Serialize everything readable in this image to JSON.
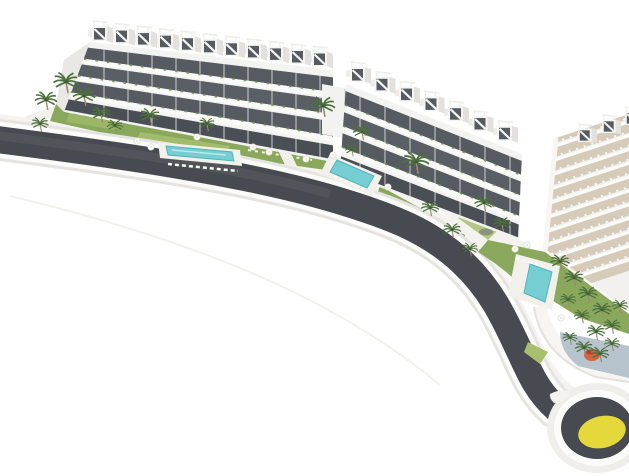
{
  "scene": {
    "type": "architectural-aerial-render",
    "subject": "curved white apartment complex with rooftop pergola penthouses, landscaped gardens, three swimming pools, palm trees, a dark perimeter road with white curbs and a roundabout with a yellow painted centre",
    "background": "#ffffff",
    "buildings": [
      {
        "name": "west-apartment-block",
        "floors_visible": 4,
        "rooftop_units": 11
      },
      {
        "name": "central-apartment-block",
        "floors_visible": 4,
        "rooftop_units": 7
      },
      {
        "name": "east-terraced-wing",
        "terrace_rows": 12
      }
    ],
    "pools": [
      {
        "name": "west-pool",
        "shape": "rectangular"
      },
      {
        "name": "central-pool",
        "shape": "rectangular"
      },
      {
        "name": "east-pool",
        "shape": "rectangular"
      }
    ],
    "road": {
      "name": "perimeter-road",
      "features": [
        "white-curbs",
        "roundabout-with-yellow-centre",
        "splitter-island"
      ]
    },
    "amenities": [
      "sun-loungers",
      "parasols",
      "lawns",
      "hedges",
      "orange-play-area",
      "blue-grey-courtyard"
    ],
    "palm_tree_count_approx": 30,
    "parasol_count_approx": 12
  },
  "palette": {
    "background": "#ffffff",
    "road_asphalt": "#474a50",
    "road_sheen": "#6a6d72",
    "road_curb": "#fbfbf9",
    "curb_shadow": "#e6e4e0",
    "roundabout_yellow": "#e5d83a",
    "pool_water": "#77ced2",
    "pool_water_deep": "#4fb4bf",
    "pool_deck": "#f2f0ea",
    "lawn": "#8aa85c",
    "lawn_light": "#a9bf70",
    "hedge": "#5f7d45",
    "shrub_grey": "#8b9478",
    "palm_frond": "#4d6f3d",
    "palm_trunk": "#9a8a72",
    "building_white": "#f3f3f1",
    "building_shadow": "#e1e0dd",
    "window_glass": "#565b61",
    "terrace_floor": "#d6cbb8",
    "promenade": "#f4f3ef",
    "courtyard_floor": "#b7c4cd",
    "play_area_orange": "#d4643a",
    "play_area_red": "#c0392b"
  }
}
